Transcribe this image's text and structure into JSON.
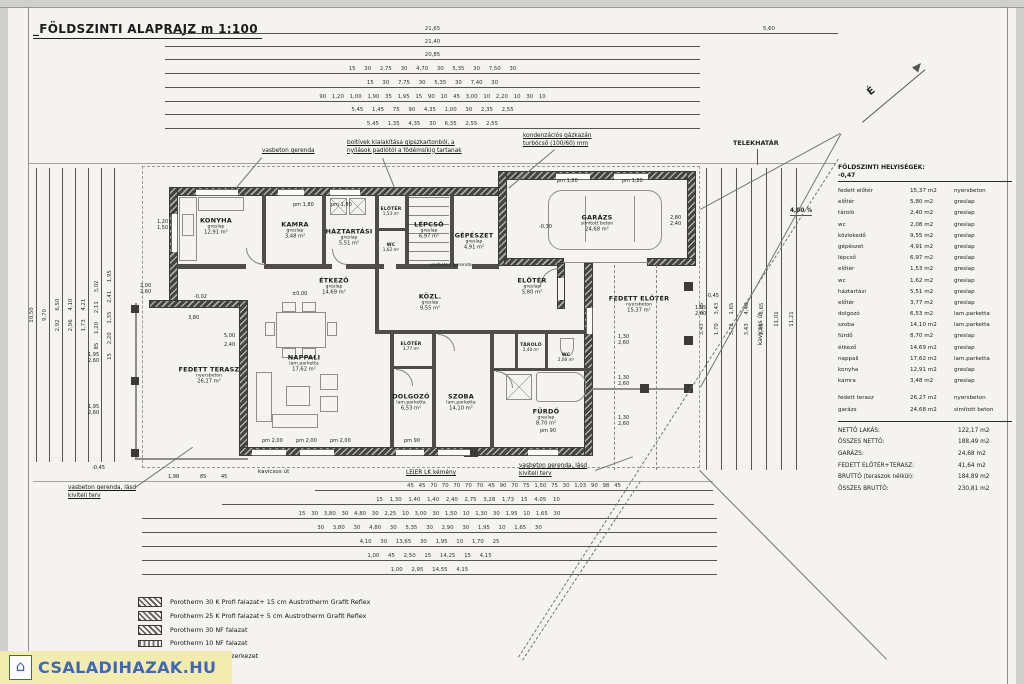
{
  "title": "_FÖLDSZINTI ALAPRAJZ m 1:100",
  "north_label": "É",
  "site": {
    "telekhatar": "TELEKHATÁR",
    "slope": "4,00 %",
    "road_v": "kavicsos út",
    "road_h": "kavicsos út"
  },
  "notes": {
    "vgt": "vasbeton gerenda",
    "boltivek1": "boltívek kialakítása gipszkartonból, a",
    "boltivek2": "nyílások padlótól a födémsíkig tartanak",
    "gaz1": "kondenzációs gázkazán",
    "gaz2": "turbócső (100/60) mm",
    "vgi": "vasbeton gerenda",
    "vgb1": "vasbeton gerenda, lásd",
    "vgb2": "kiviteli terv",
    "kemeny": "LEIER LK kémény"
  },
  "levels": {
    "zero": "±0,00",
    "m002": "-0,02",
    "m030": "-0,30",
    "m045": "-0,45",
    "m047": "-0,47"
  },
  "parapets": {
    "pm180": "pm 1,80",
    "pm200": "pm 2,00",
    "pm90": "pm 90"
  },
  "rooms": [
    {
      "name": "KONYHA",
      "finish": "greslap",
      "area": "12,91 m²"
    },
    {
      "name": "KAMRA",
      "finish": "greslap",
      "area": "3,48 m²"
    },
    {
      "name": "HÁZTARTÁSI",
      "finish": "greslap",
      "area": "5,51 m²"
    },
    {
      "name": "LÉPCSŐ",
      "finish": "greslap",
      "area": "6,97 m²"
    },
    {
      "name": "GÉPÉSZET",
      "finish": "greslap",
      "area": "4,91 m²"
    },
    {
      "name": "GARÁZS",
      "finish": "simított beton",
      "area": "24,68 m²"
    },
    {
      "name": "ELŐTÉR",
      "finish": "greslap",
      "area": "5,80 m²"
    },
    {
      "name": "FEDETT ELŐTÉR",
      "finish": "nyersbeton",
      "area": "15,37 m²"
    },
    {
      "name": "ÉTKEZŐ",
      "finish": "greslap",
      "area": "14,69 m²"
    },
    {
      "name": "KÖZL.",
      "finish": "greslap",
      "area": "9,55 m²"
    },
    {
      "name": "NAPPALI",
      "finish": "lam.parketta",
      "area": "17,62 m²"
    },
    {
      "name": "FEDETT TERASZ",
      "finish": "nyersbeton",
      "area": "26,27 m²"
    },
    {
      "name": "ELŐTÉR",
      "finish": "greslap",
      "area": "3,77 m²"
    },
    {
      "name": "DOLGOZÓ",
      "finish": "lam.parketta",
      "area": "6,53 m²"
    },
    {
      "name": "SZOBA",
      "finish": "lam.parketta",
      "area": "14,10 m²"
    },
    {
      "name": "FÜRDŐ",
      "finish": "greslap",
      "area": "8,70 m²"
    },
    {
      "name": "TÁROLÓ",
      "finish": "greslap",
      "area": "2,40 m²"
    },
    {
      "name": "WC",
      "finish": "",
      "area": "2,08 m²"
    },
    {
      "name": "ELŐTÉR",
      "finish": "",
      "area": "1,53 m²"
    },
    {
      "name": "WC",
      "finish": "",
      "area": "1,62 m²"
    }
  ],
  "dims": {
    "top": [
      "21,65",
      "21,40",
      "20,85",
      "15 30 2,75 30 4,70 30 5,35 30 7,50 30",
      "15 30 7,75 30 5,35 30 7,40 30",
      "90 1,20 1,00 1,90 35 1,95 15 90 10 45 3,00 10 2,20 10 30 10",
      "5,45 1,45 75 90 4,35 1,00 30 2,35 2,55",
      "5,45 1,35 4,35 30 6,35 2,55 2,55"
    ],
    "top_right": "5,60",
    "bottom": [
      "45 45 70 70 70 70 70 45 90 70 75 1,50 75 30 1,03 90 98 45",
      "15 1,30 1,40 1,40 2,40 2,75 3,28 1,73 15 4,05 10",
      "15 30 3,80 30 4,80 30 2,25 10 3,00 30 1,50 10 1,30 30 1,95 10 1,65 30",
      "30 3,80 30 4,80 30 5,35 30 2,90 30 1,95 10 1,65 30",
      "4,10 30 13,65 30 1,95 10 1,70 25",
      "1,00 45 2,50 15 14,25 15 4,15",
      "1,00 2,95 14,55 4,15"
    ],
    "left": [
      "10,50",
      "9,70",
      "2,92 6,50",
      "2,96 4,10",
      "1,73 4,21",
      "85 1,20 2,11 3,02",
      "15 2,20 1,35 2,41 1,95"
    ],
    "right": [
      "3,43 1,35",
      "1,70 3,43",
      "3,78 1,65",
      "3,43 4,48",
      "1,45 3,65",
      "11,01",
      "11,21"
    ],
    "pairs": [
      {
        "a": "2,00",
        "b": "2,60"
      },
      {
        "a": "1,20",
        "b": "1,50"
      },
      {
        "a": "1,95",
        "b": "2,60"
      },
      {
        "a": "1,95",
        "b": "2,60"
      },
      {
        "a": "1,95",
        "b": "2,60"
      },
      {
        "a": "1,30",
        "b": "2,60"
      },
      {
        "a": "1,30",
        "b": "2,60"
      },
      {
        "a": "1,30",
        "b": "2,60"
      },
      {
        "a": "2,80",
        "b": "2,40"
      }
    ],
    "extra": {
      "d380": "3,80",
      "d500": "5,00",
      "d240": "2,40",
      "d198": "1,98",
      "d85": "85",
      "d45": "45"
    }
  },
  "schedule": {
    "header": "FÖLDSZINTI HELYISÉGEK:",
    "level": "-0,47",
    "rows": [
      {
        "n": "fedett előtér",
        "a": "15,37 m2",
        "f": "nyersbeton"
      },
      {
        "n": "előtér",
        "a": "5,80 m2",
        "f": "greslap"
      },
      {
        "n": "tároló",
        "a": "2,40 m2",
        "f": "greslap"
      },
      {
        "n": "wc",
        "a": "2,08 m2",
        "f": "greslap"
      },
      {
        "n": "közlekedő",
        "a": "9,55 m2",
        "f": "greslap"
      },
      {
        "n": "gépészet",
        "a": "4,91 m2",
        "f": "greslap"
      },
      {
        "n": "lépcső",
        "a": "6,97 m2",
        "f": "greslap"
      },
      {
        "n": "előtér",
        "a": "1,53 m2",
        "f": "greslap"
      },
      {
        "n": "wc",
        "a": "1,62 m2",
        "f": "greslap"
      },
      {
        "n": "háztartási",
        "a": "5,51 m2",
        "f": "greslap"
      },
      {
        "n": "előtér",
        "a": "3,77 m2",
        "f": "greslap"
      },
      {
        "n": "dolgozó",
        "a": "6,53 m2",
        "f": "lam.parketta"
      },
      {
        "n": "szoba",
        "a": "14,10 m2",
        "f": "lam.parketta"
      },
      {
        "n": "fürdő",
        "a": "8,70 m2",
        "f": "greslap"
      },
      {
        "n": "étkező",
        "a": "14,69 m2",
        "f": "greslap"
      },
      {
        "n": "nappali",
        "a": "17,62 m2",
        "f": "lam.parketta"
      },
      {
        "n": "konyha",
        "a": "12,91 m2",
        "f": "greslap"
      },
      {
        "n": "kamra",
        "a": "3,48 m2",
        "f": "greslap"
      }
    ],
    "rows2": [
      {
        "n": "fedett terasz",
        "a": "26,27 m2",
        "f": "nyersbeton"
      },
      {
        "n": "garázs",
        "a": "24,68 m2",
        "f": "simított beton"
      }
    ],
    "totals": [
      {
        "l": "NETTÓ LAKÁS:",
        "v": "122,17 m2"
      },
      {
        "l": "ÖSSZES NETTÓ:",
        "v": "188,49 m2"
      },
      {
        "l": "GARÁZS:",
        "v": "24,68 m2"
      },
      {
        "l": "FEDETT ELŐTÉR+TERASZ:",
        "v": "41,64 m2"
      },
      {
        "l": "BRUTTÓ (teraszok nélkül):",
        "v": "184,89 m2"
      },
      {
        "l": "ÖSSZES BRUTTÓ:",
        "v": "230,81 m2"
      }
    ]
  },
  "legend": [
    {
      "label": "Porotherm 30 K Profi falazat+ 15 cm Austrotherm Grafit Reflex"
    },
    {
      "label": "Porotherm 25 K Profi falazat+ 5 cm Austrotherm Grafit Reflex"
    },
    {
      "label": "Porotherm 30 NF falazat"
    },
    {
      "label": "Porotherm 10 NF falazat"
    },
    {
      "label": "monolit vasbeton szerkezet"
    }
  ],
  "watermark": {
    "text": "CSALADIHAZAK.HU"
  }
}
